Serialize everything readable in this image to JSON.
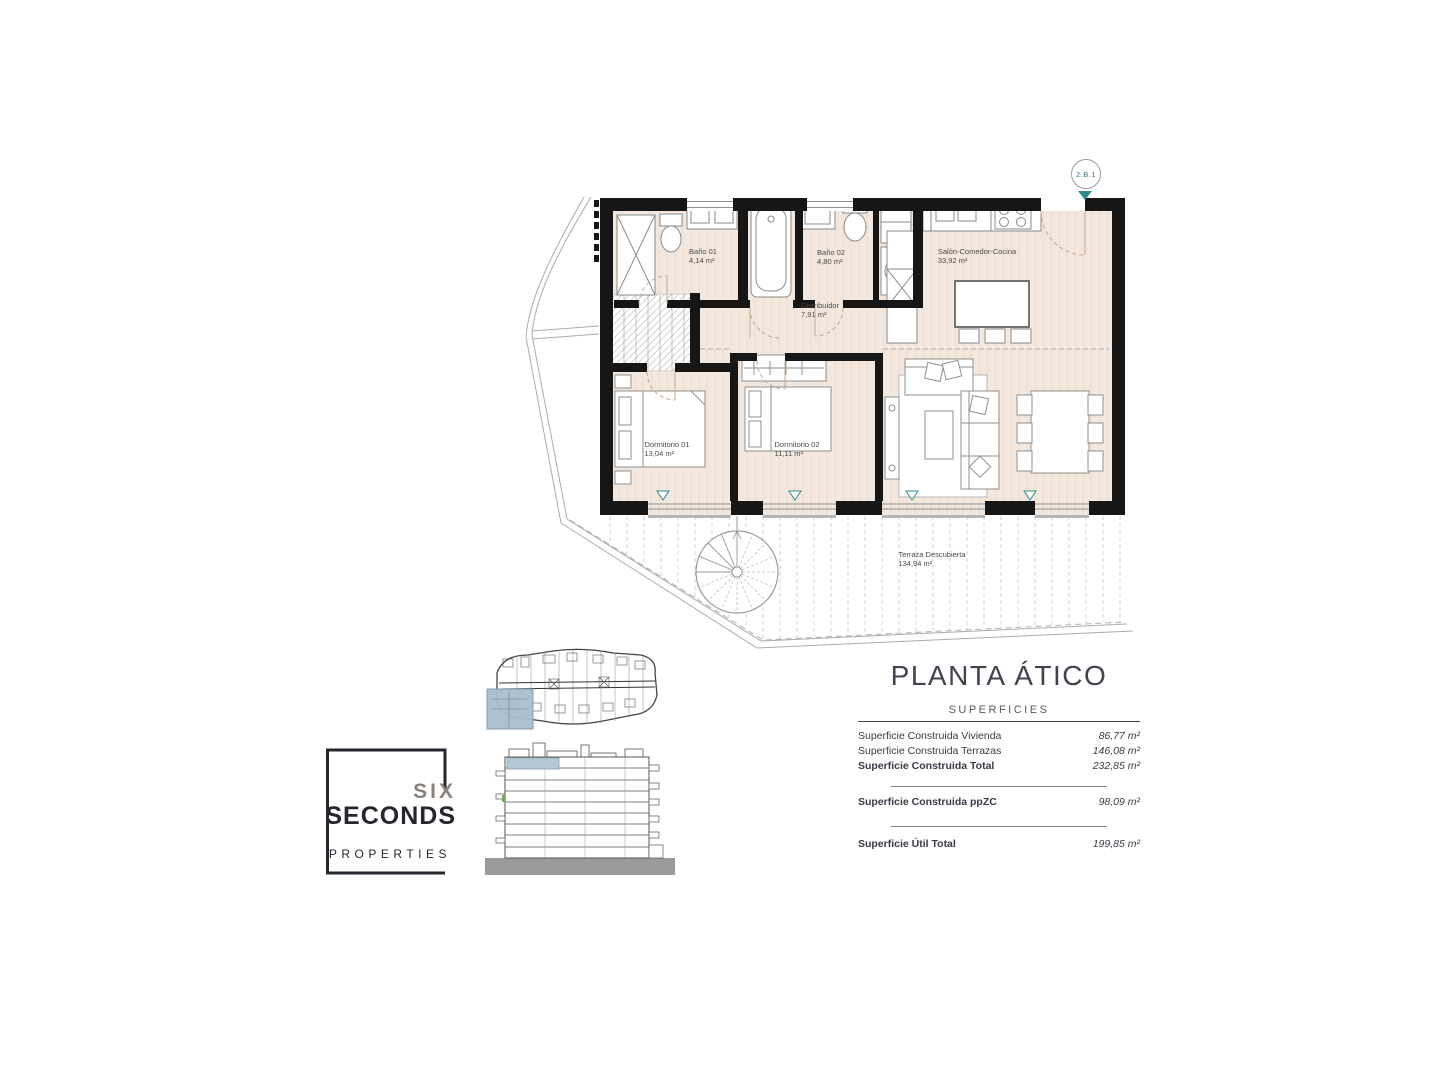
{
  "badge": {
    "label": "2.B.1",
    "accent": "#2e8b8b"
  },
  "floor_plan": {
    "floor_color": "#f4e8de",
    "wall_color": "#161616",
    "rooms": [
      {
        "name": "Baño 01",
        "area": "4,14 m²"
      },
      {
        "name": "Baño 02",
        "area": "4,80 m²"
      },
      {
        "name": "Distribuidor",
        "area": "7,91 m²"
      },
      {
        "name": "Salón-Comedor-Cocina",
        "area": "33,92 m²"
      },
      {
        "name": "Dormitorio 01",
        "area": "13,04 m²"
      },
      {
        "name": "Dormitorio 02",
        "area": "11,11 m²"
      },
      {
        "name": "Terraza Descubierta",
        "area": "134,94 m²"
      }
    ]
  },
  "logo": {
    "line1": "SIX",
    "line2": "SECONDS",
    "line3": "PROPERTIES"
  },
  "title_block": {
    "title": "PLANTA ÁTICO",
    "subtitle": "SUPERFICIES",
    "rows": [
      {
        "label": "Superficie Construida Vivienda",
        "value": "86,77 m²"
      },
      {
        "label": "Superficie Construida Terrazas",
        "value": "146,08 m²"
      },
      {
        "label": "Superficie Construida Total",
        "value": "232,85 m²"
      },
      {
        "label": "Superficie Construida ppZC",
        "value": "98,09 m²"
      },
      {
        "label": "Superficie Útil Total",
        "value": "199,85 m²"
      }
    ]
  }
}
